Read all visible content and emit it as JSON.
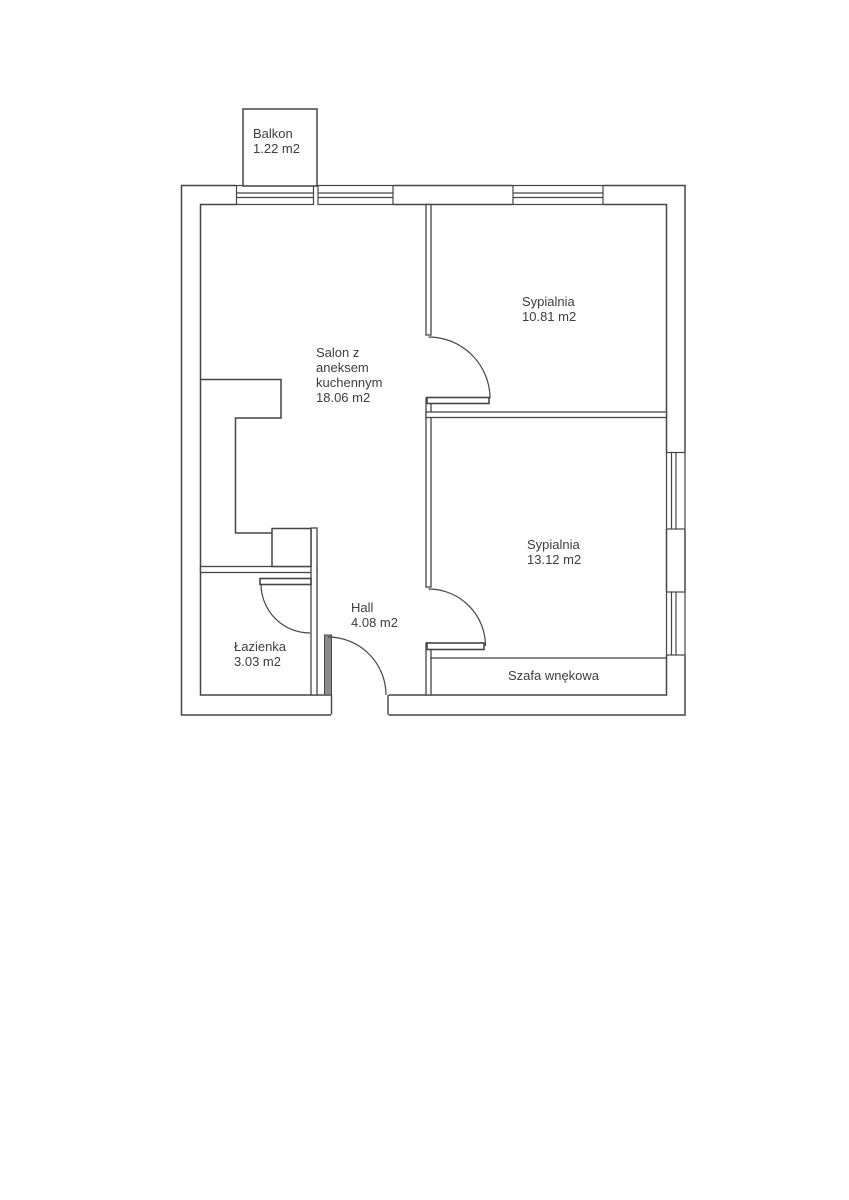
{
  "plan": {
    "rooms": {
      "balkon": {
        "name": "Balkon",
        "area": "1.22 m2"
      },
      "salon": {
        "name_lines": [
          "Salon z",
          "aneksem",
          "kuchennym"
        ],
        "area": "18.06 m2"
      },
      "sypialnia_1": {
        "name": "Sypialnia",
        "area": "10.81 m2"
      },
      "sypialnia_2": {
        "name": "Sypialnia",
        "area": "13.12 m2"
      },
      "hall": {
        "name": "Hall",
        "area": "4.08 m2"
      },
      "lazienka": {
        "name": "Łazienka",
        "area": "3.03 m2"
      },
      "szafa": {
        "name": "Szafa wnękowa"
      }
    },
    "colors": {
      "wall_line": "#454545",
      "text": "#3d3d3d",
      "door_leaf_fill": "#8c8c8c",
      "background": "#ffffff"
    }
  }
}
